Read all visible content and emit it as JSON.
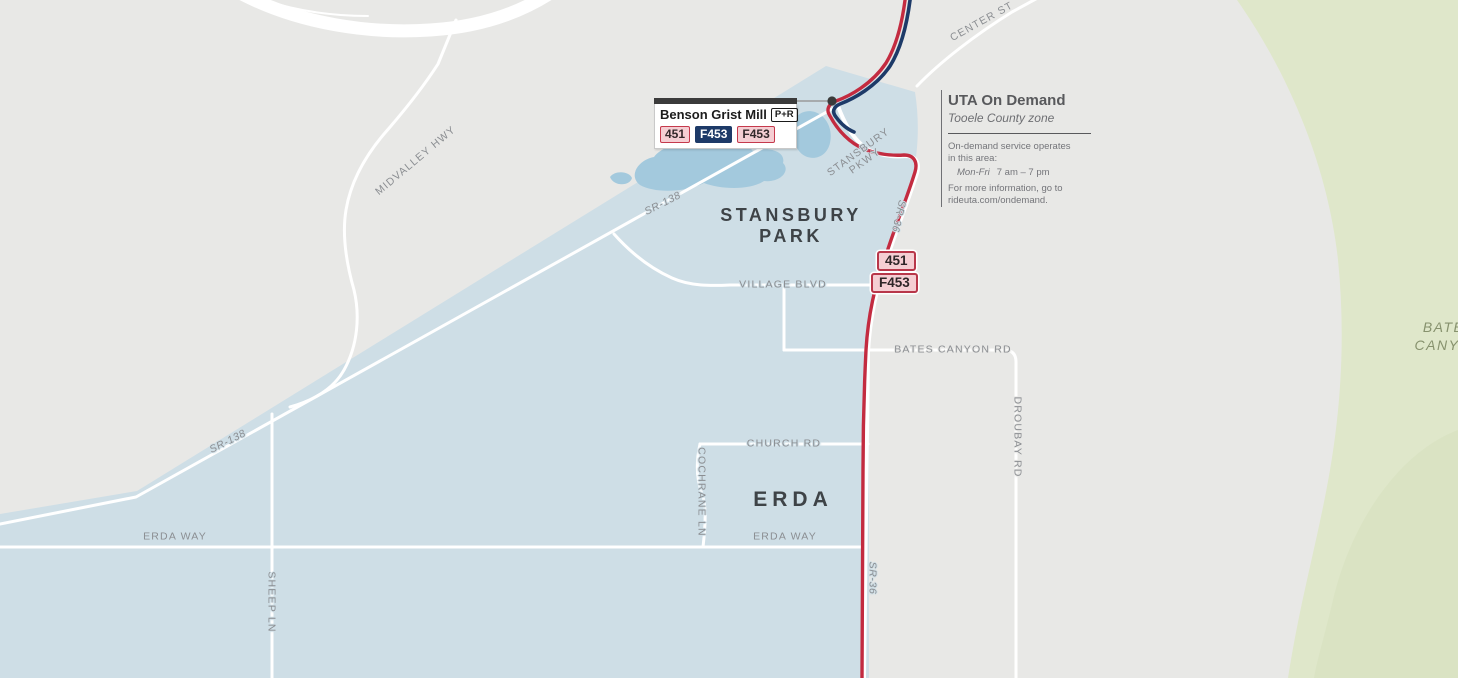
{
  "colors": {
    "background": "#e8e8e6",
    "on_demand_zone": "#cedee6",
    "water": "#a3c9dd",
    "terrain_green": "#dfe7ca",
    "road": "#ffffff",
    "route_451_red": "#c32b40",
    "route_f453_navy": "#1d3a68",
    "badge_pink_fill": "#f5ced3"
  },
  "places": {
    "stansbury_park_line1": "STANSBURY",
    "stansbury_park_line2": "PARK",
    "erda": "ERDA",
    "bates_canyon_line1": "BATES",
    "bates_canyon_line2": "CANYON"
  },
  "roads": {
    "center_st": "CENTER ST",
    "midvalley_hwy": "MIDVALLEY HWY",
    "sr_138": "SR-138",
    "stansbury_pkwy_line1": "STANSBURY",
    "stansbury_pkwy_line2": "PKWY",
    "sr_36": "SR-36",
    "village_blvd": "VILLAGE BLVD",
    "bates_canyon_rd": "BATES CANYON RD",
    "droubay_rd": "DROUBAY RD",
    "church_rd": "CHURCH RD",
    "cochrane_ln": "COCHRANE LN",
    "erda_way": "ERDA WAY",
    "sheep_ln": "SHEEP LN"
  },
  "stop": {
    "name": "Benson Grist Mill",
    "park_and_ride": "P+R",
    "badges": [
      {
        "route": "451",
        "style": "outline-red"
      },
      {
        "route": "F453",
        "style": "solid-navy"
      },
      {
        "route": "F453",
        "style": "outline-red"
      }
    ]
  },
  "route_markers": {
    "marker_451": "451",
    "marker_f453": "F453"
  },
  "info_panel": {
    "title": "UTA On Demand",
    "subtitle": "Tooele County zone",
    "body_line1": "On-demand service operates",
    "body_line2": "in this area:",
    "schedule_days": "Mon-Fri",
    "schedule_hours": "7 am – 7 pm",
    "footer_line1": "For more information, go to",
    "footer_line2": "rideuta.com/ondemand."
  }
}
